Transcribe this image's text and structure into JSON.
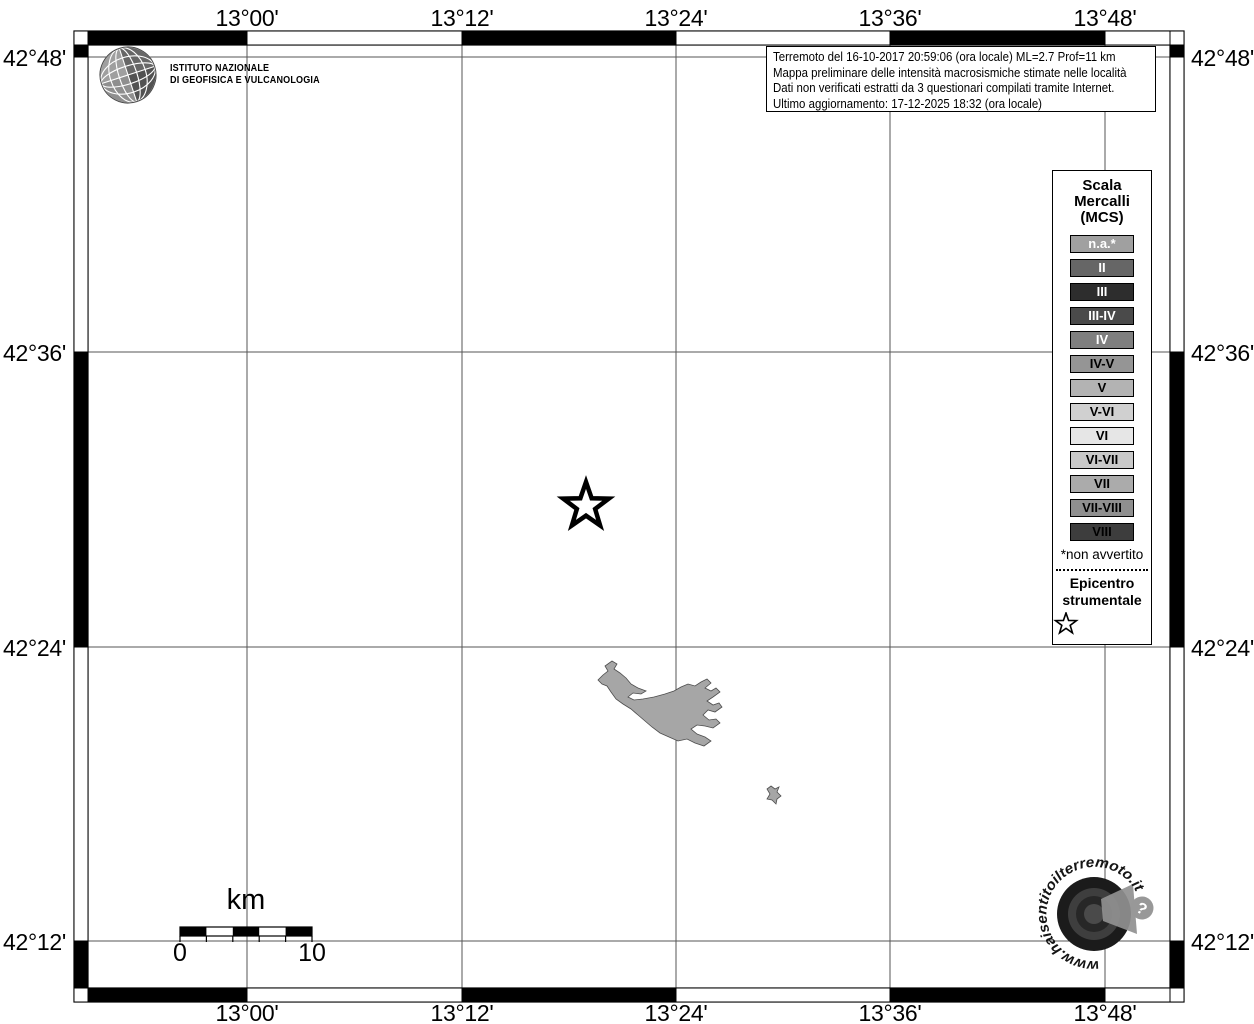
{
  "header": {
    "ingv_line1": "ISTITUTO NAZIONALE",
    "ingv_line2": "DI GEOFISICA E VULCANOLOGIA"
  },
  "info_box": {
    "line1": "Terremoto del 16-10-2017 20:59:06 (ora locale) ML=2.7 Prof=11 km",
    "line2": "Mappa preliminare delle intensità macrosismiche stimate nelle località",
    "line3": "Dati non verificati estratti da 3 questionari compilati tramite Internet.",
    "line4": "Ultimo aggiornamento: 17-12-2025 18:32 (ora locale)"
  },
  "axes": {
    "lon": [
      "13°00'",
      "13°12'",
      "13°24'",
      "13°36'",
      "13°48'"
    ],
    "lat": [
      "42°48'",
      "42°36'",
      "42°24'",
      "42°12'"
    ]
  },
  "legend": {
    "title_lines": [
      "Scala",
      "Mercalli",
      "(MCS)"
    ],
    "items": [
      {
        "label": "n.a.*",
        "bg": "#a0a0a0",
        "fg": "#ffffff"
      },
      {
        "label": "II",
        "bg": "#666666",
        "fg": "#ffffff"
      },
      {
        "label": "III",
        "bg": "#2d2d2d",
        "fg": "#ffffff"
      },
      {
        "label": "III-IV",
        "bg": "#4a4a4a",
        "fg": "#ffffff"
      },
      {
        "label": "IV",
        "bg": "#7f7f7f",
        "fg": "#ffffff"
      },
      {
        "label": "IV-V",
        "bg": "#959595",
        "fg": "#000000"
      },
      {
        "label": "V",
        "bg": "#b3b3b3",
        "fg": "#000000"
      },
      {
        "label": "V-VI",
        "bg": "#d0d0d0",
        "fg": "#000000"
      },
      {
        "label": "VI",
        "bg": "#e6e6e6",
        "fg": "#000000"
      },
      {
        "label": "VI-VII",
        "bg": "#c9c9c9",
        "fg": "#000000"
      },
      {
        "label": "VII",
        "bg": "#ababab",
        "fg": "#000000"
      },
      {
        "label": "VII-VIII",
        "bg": "#8f8f8f",
        "fg": "#000000"
      },
      {
        "label": "VIII",
        "bg": "#3d3d3d",
        "fg": "#000000"
      }
    ],
    "note": "*non avvertito",
    "epicenter_label": "Epicentro strumentale"
  },
  "scale_bar": {
    "unit": "km",
    "start": "0",
    "end": "10"
  },
  "watermark": {
    "text": "www.haisentitoilterremoto.it",
    "question_mark": "?"
  },
  "map": {
    "lake_color": "#a6a6a6",
    "grid_color": "#555555"
  }
}
